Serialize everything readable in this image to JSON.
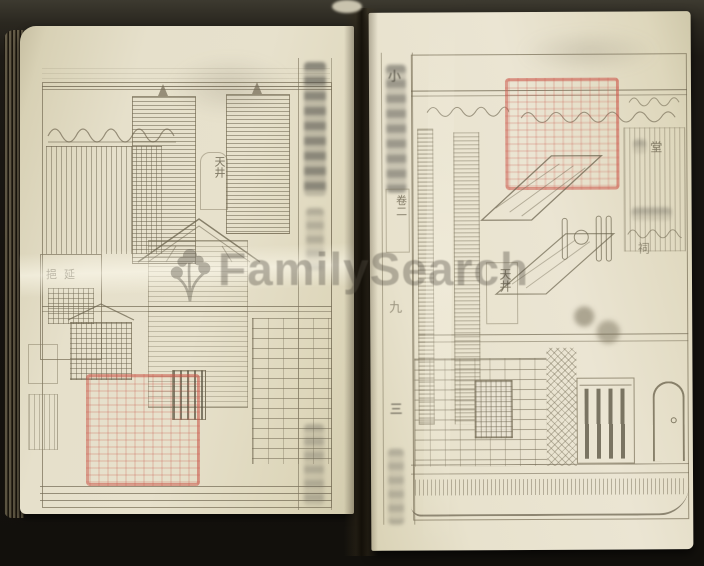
{
  "watermark": {
    "text": "FamilySearch",
    "icon": "familysearch-tree-icon",
    "color": "#544f44"
  },
  "colors": {
    "surround_background": "#17140f",
    "paper": "#e6e0cb",
    "paper_edge": "#cdc5a8",
    "print_ink": "#8b8268",
    "seal_red": "#c9584a",
    "watermark_text": "#544f44"
  },
  "left_page": {
    "labels": {
      "courtyard": "天井",
      "pavilion": "挹延"
    },
    "seal": "red-square-collection-seal",
    "title_strip": "illegible-vertical-title-characters"
  },
  "right_page": {
    "labels": {
      "gutter_title_first": "小",
      "volume": "卷二",
      "page_number": "九",
      "section_number": "三",
      "courtyard": "天井",
      "hall": "堂",
      "shrine": "祠"
    },
    "seal": "red-square-collection-seal",
    "gutter_title": "illegible-vertical-title-characters"
  }
}
